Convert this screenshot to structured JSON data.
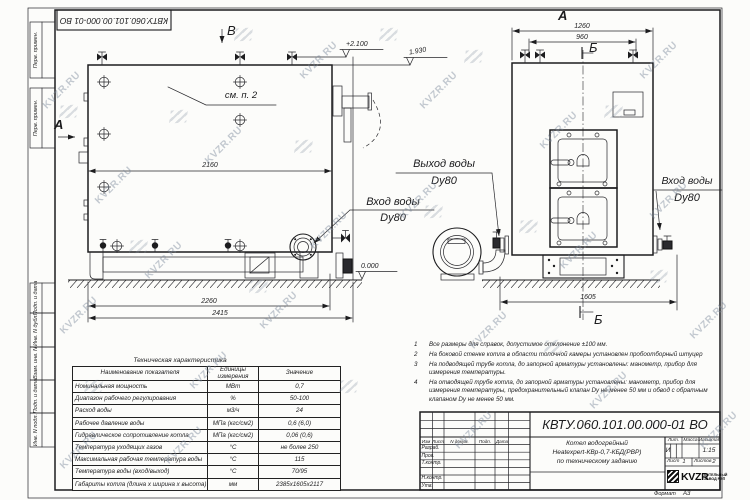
{
  "sheet": {
    "stamp_top": "КВТУ.060.101.00.000-01 ВО"
  },
  "watermark": {
    "text": "KVZR.RU"
  },
  "margin": {
    "top": [
      "Перв. примен.",
      "Перв. примен."
    ],
    "bottom": [
      "Подп. и дата",
      "Инв. N дубл.",
      "Взам. инв. N",
      "Подп. и дата",
      "Инв. N подл."
    ]
  },
  "side_view": {
    "section_label_a": "А",
    "section_label_b": "В",
    "see_note": "см. п. 2",
    "dim_2160": "2160",
    "dim_2260": "2260",
    "dim_2415": "2415",
    "elev_top": "+2.100",
    "elev_chimney": "1.930",
    "elev_zero": "0.000",
    "inlet_line1": "Вход воды",
    "inlet_line2": "Dy80"
  },
  "front_view": {
    "view_label": "А",
    "section_b_top": "Б",
    "section_b_bottom": "Б",
    "dim_1260": "1260",
    "dim_960": "960",
    "dim_1605": "1605",
    "outlet_line1": "Выход воды",
    "outlet_line2": "Dy80",
    "inlet_line1": "Вход воды",
    "inlet_line2": "Dy80"
  },
  "spec_table": {
    "title": "Техническая характеристика",
    "headers": [
      "Наименование показателя",
      "Единицы измерения",
      "Значение"
    ],
    "rows": [
      [
        "Номинальная мощность",
        "МВт",
        "0,7"
      ],
      [
        "Диапазон рабочего регулирования",
        "%",
        "50-100"
      ],
      [
        "Расход воды",
        "м3/ч",
        "24"
      ],
      [
        "Рабочее давление воды",
        "МПа (кгс/см2)",
        "0,6 (6,0)"
      ],
      [
        "Гидравлическое сопротивление котла",
        "МПа (кгс/см2)",
        "0,06 (0,6)"
      ],
      [
        "Температура уходящих газов",
        "°С",
        "не более 250"
      ],
      [
        "Максимальная рабочая температура воды",
        "°С",
        "115"
      ],
      [
        "Температура воды (вход/выход)",
        "°С",
        "70/95"
      ],
      [
        "Габариты котла (длина х ширина х высота)",
        "мм",
        "2385х1605х2117"
      ]
    ]
  },
  "notes": [
    {
      "num": "1",
      "text": "Все размеры для справок, допустимое отклонение ±100 мм."
    },
    {
      "num": "2",
      "text": "На боковой стенке котла в области топочной камеры установлен пробоотборный штуцер"
    },
    {
      "num": "3",
      "text": "На подводящей трубе котла, до запорной арматуры установлены: манометр, прибор для измерения температуры."
    },
    {
      "num": "4",
      "text": "На отводящей трубе котла, до запорной арматуры установлены: манометр, прибор для измерения температуры, предохранительный клапан Dу не менее 50 мм и обвод с обратным клапаном Dу не менее 50 мм."
    }
  ],
  "title_block": {
    "doc_number": "КВТУ.060.101.00.000-01 ВО",
    "col_headers": [
      "Изм",
      "Лист",
      "N докум.",
      "Подп.",
      "Дата"
    ],
    "row_labels": [
      "Разраб.",
      "Пров.",
      "Т.контр.",
      "Н.контр.",
      "Утв."
    ],
    "title_line1": "Котел водогрейный",
    "title_line2": "Heatexpert-КВр-0,7-КБД(РВР)",
    "title_line3": "по техническому заданию",
    "lit_header": "Лит.",
    "lit_value": "И",
    "mass_header": "Масса",
    "scale_header": "Масштаб",
    "scale_value": "1:15",
    "sheet_label": "Лист",
    "sheet_value": "1",
    "sheets_label": "Листов",
    "sheets_value": "2",
    "company_name": "KVZR",
    "company_sub1": "КОТЕЛЬНЫЙ",
    "company_sub2": "ЗАВОД РЭП",
    "format_label": "Формат",
    "format_value": "А3"
  }
}
